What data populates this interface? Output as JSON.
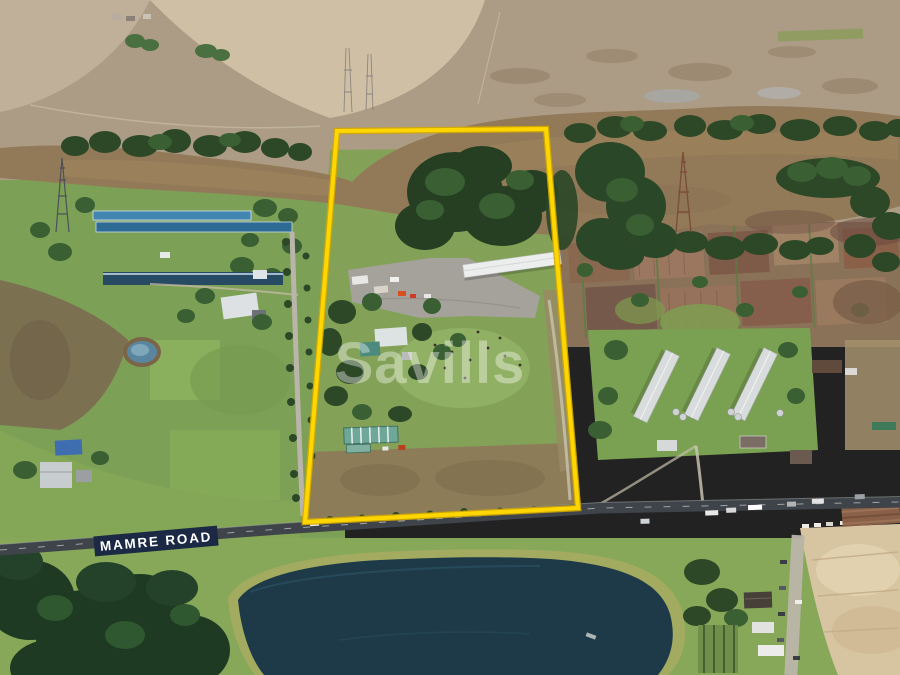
{
  "overlays": {
    "road_label": "MAMRE ROAD",
    "watermark": "Savills"
  },
  "colors": {
    "boundary": "#FFD600",
    "road_label_bg": "#1B2944",
    "road_label_text": "#FFFFFF",
    "watermark": "#FFFFFF"
  }
}
